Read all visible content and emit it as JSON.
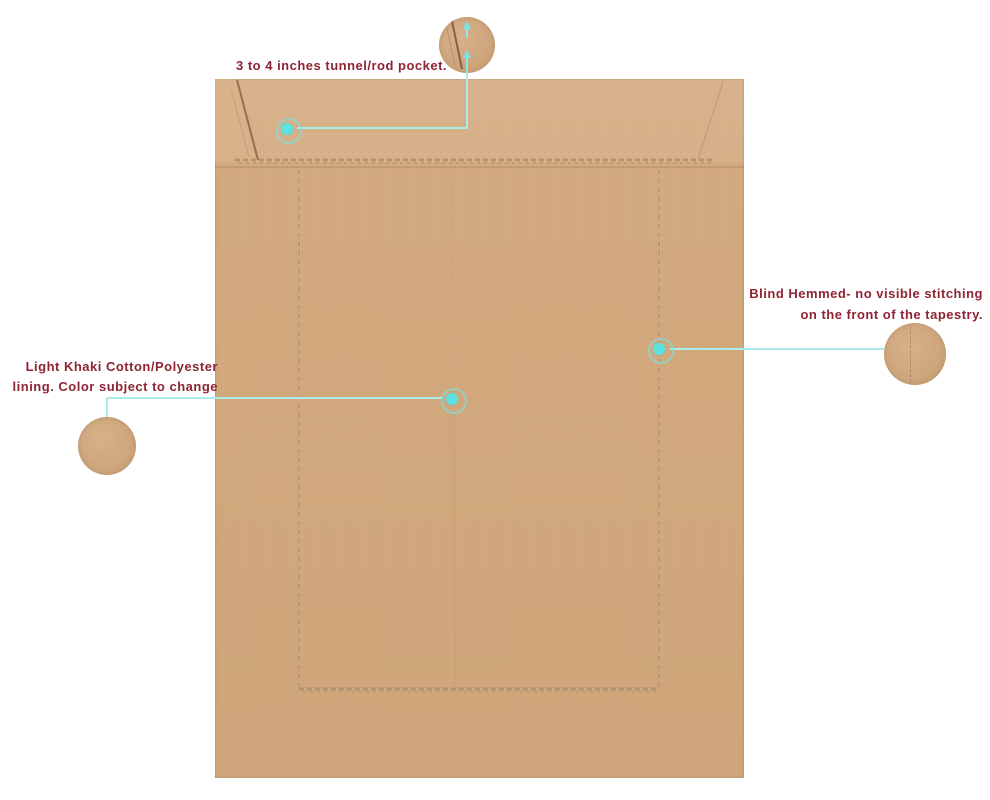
{
  "colors": {
    "background": "#ffffff",
    "fabric": "#d2a97d",
    "fabric_fold_light": "#dab289",
    "stitch": "#9a7c5c",
    "accent_dot": "#5ce2e1",
    "connector_line": "#aaeceb",
    "label_text": "#8e2433"
  },
  "annotations": {
    "rod_pocket": {
      "text": "3 to 4 inches tunnel/rod pocket."
    },
    "blind_hem": {
      "line1": "Blind Hemmed- no visible stitching",
      "line2": "on the front of the tapestry."
    },
    "lining": {
      "line1": "Light Khaki Cotton/Polyester",
      "line2": "lining. Color subject to change"
    }
  }
}
